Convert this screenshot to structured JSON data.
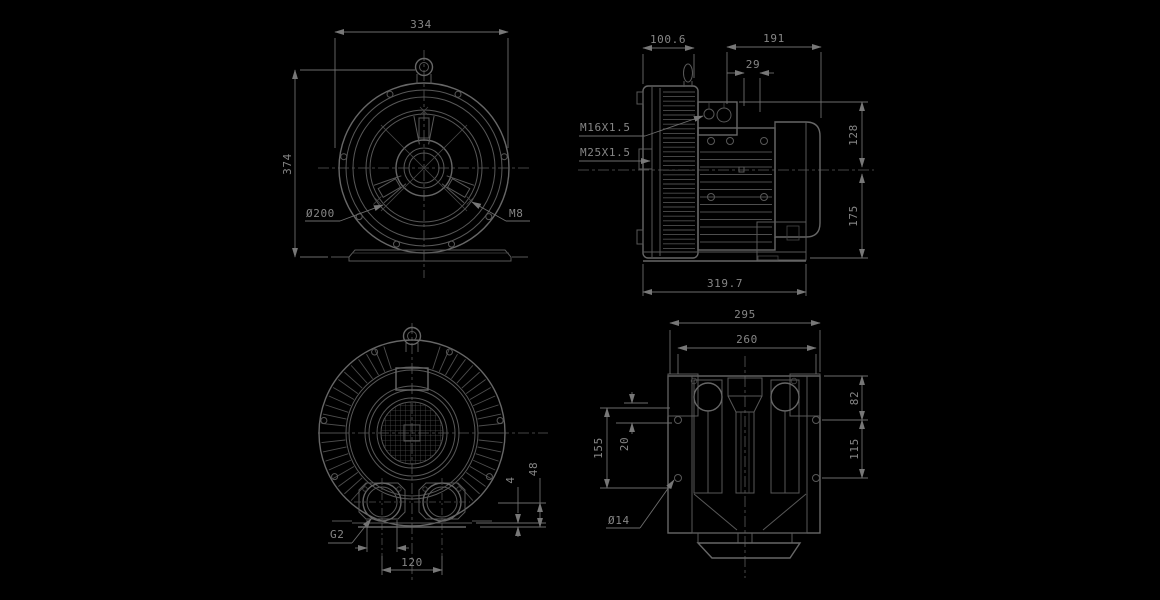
{
  "palette": {
    "background": "#000000",
    "geometry_line": "#585858",
    "dimension_line": "#6d6d6d",
    "text": "#868686"
  },
  "views": {
    "front": {
      "dims": {
        "width": "334",
        "height": "374"
      },
      "labels": {
        "bolt_circle": "Ø200",
        "bolt_thread": "M8"
      }
    },
    "side": {
      "dims": {
        "housing_depth": "100.6",
        "motor_length": "191",
        "gland_offset": "29",
        "above_axis": "128",
        "below_axis": "175",
        "overall_length": "319.7"
      },
      "labels": {
        "gland_small": "M16X1.5",
        "gland_large": "M25X1.5"
      }
    },
    "rear": {
      "dims": {
        "port_spacing": "120",
        "foot_pad": "4",
        "port_height": "48"
      },
      "labels": {
        "port_thread": "G2"
      }
    },
    "top": {
      "dims": {
        "overall_width": "295",
        "hole_span_x": "260",
        "top_to_hole": "82",
        "hole_span_y": "115",
        "left_height": "155",
        "offset": "20"
      },
      "labels": {
        "hole_dia": "Ø14"
      }
    }
  }
}
